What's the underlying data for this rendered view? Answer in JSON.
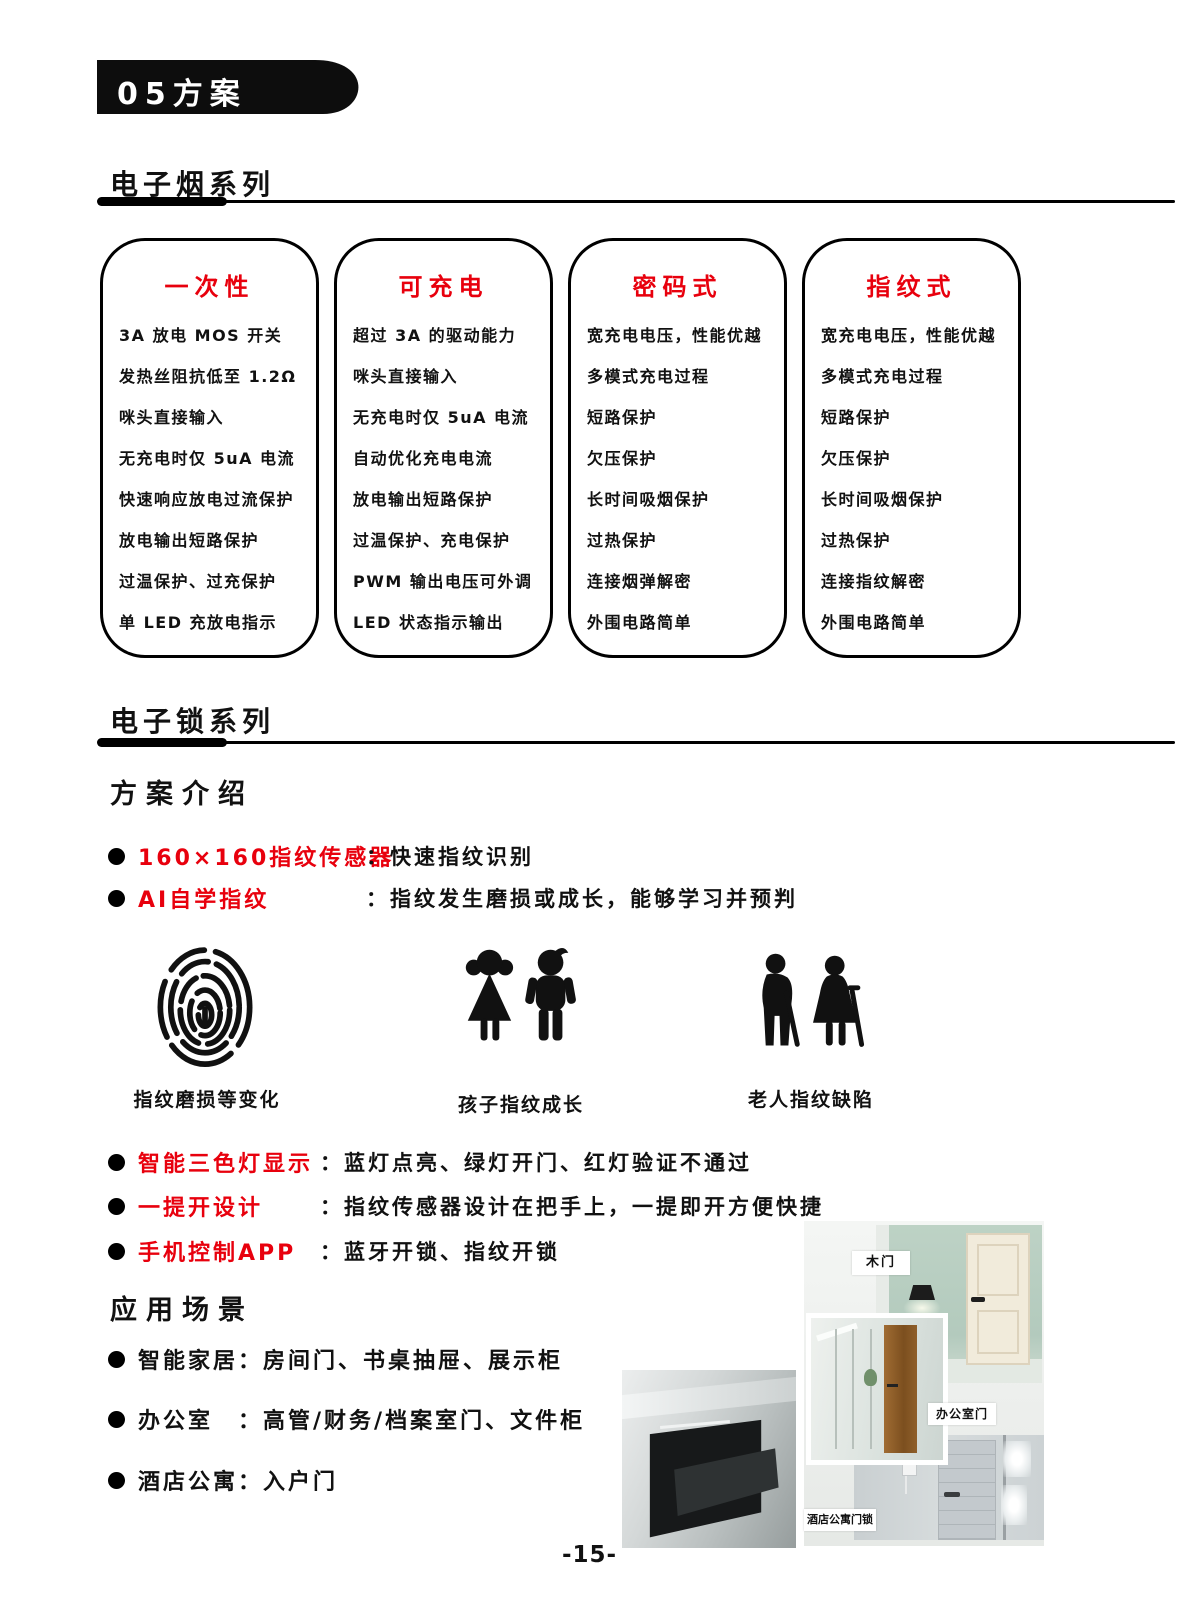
{
  "page": {
    "banner": "05方案",
    "page_number": "-15-"
  },
  "sections": {
    "ecig": {
      "title": "电子烟系列"
    },
    "elock": {
      "title": "电子锁系列"
    },
    "intro": {
      "title": "方案介绍"
    },
    "scenes": {
      "title": "应用场景"
    }
  },
  "cards": [
    {
      "title": "一次性",
      "items": [
        "3A 放电 MOS 开关",
        "发热丝阻抗低至 1.2Ω",
        "咪头直接输入",
        "无充电时仅 5uA 电流",
        "快速响应放电过流保护",
        "放电输出短路保护",
        "过温保护、过充保护",
        "单 LED 充放电指示"
      ]
    },
    {
      "title": "可充电",
      "items": [
        "超过 3A 的驱动能力",
        "咪头直接输入",
        "无充电时仅 5uA 电流",
        "自动优化充电电流",
        "放电输出短路保护",
        "过温保护、充电保护",
        "PWM 输出电压可外调",
        "LED 状态指示输出"
      ]
    },
    {
      "title": "密码式",
      "items": [
        "宽充电电压，性能优越",
        "多模式充电过程",
        "短路保护",
        "欠压保护",
        "长时间吸烟保护",
        "过热保护",
        "连接烟弹解密",
        "外围电路简单"
      ]
    },
    {
      "title": "指纹式",
      "items": [
        "宽充电电压，性能优越",
        "多模式充电过程",
        "短路保护",
        "欠压保护",
        "长时间吸烟保护",
        "过热保护",
        "连接指纹解密",
        "外围电路简单"
      ]
    }
  ],
  "features1": [
    {
      "label": "160×160指纹传感器",
      "desc": "：快速指纹识别"
    },
    {
      "label": "AI自学指纹",
      "desc": "：指纹发生磨损或成长，能够学习并预判"
    }
  ],
  "icons": [
    {
      "name": "fingerprint-icon",
      "caption": "指纹磨损等变化"
    },
    {
      "name": "children-icon",
      "caption": "孩子指纹成长"
    },
    {
      "name": "elderly-icon",
      "caption": "老人指纹缺陷"
    }
  ],
  "features2": [
    {
      "label": "智能三色灯显示",
      "desc": "：蓝灯点亮、绿灯开门、红灯验证不通过"
    },
    {
      "label": "一提开设计",
      "desc": "：指纹传感器设计在把手上，一提即开方便快捷"
    },
    {
      "label": "手机控制APP",
      "desc": "：蓝牙开锁、指纹开锁"
    }
  ],
  "applications": [
    {
      "text": "智能家居：房间门、书桌抽屉、展示柜"
    },
    {
      "text": "办公室　：高管/财务/档案室门、文件柜"
    },
    {
      "text": "酒店公寓：入户门"
    }
  ],
  "collage": {
    "wood_door_label": "木门",
    "office_door_label": "办公室门",
    "hotel_lock_label": "酒店公寓门锁"
  },
  "colors": {
    "accent_red": "#e8000d",
    "ink": "#111111"
  }
}
